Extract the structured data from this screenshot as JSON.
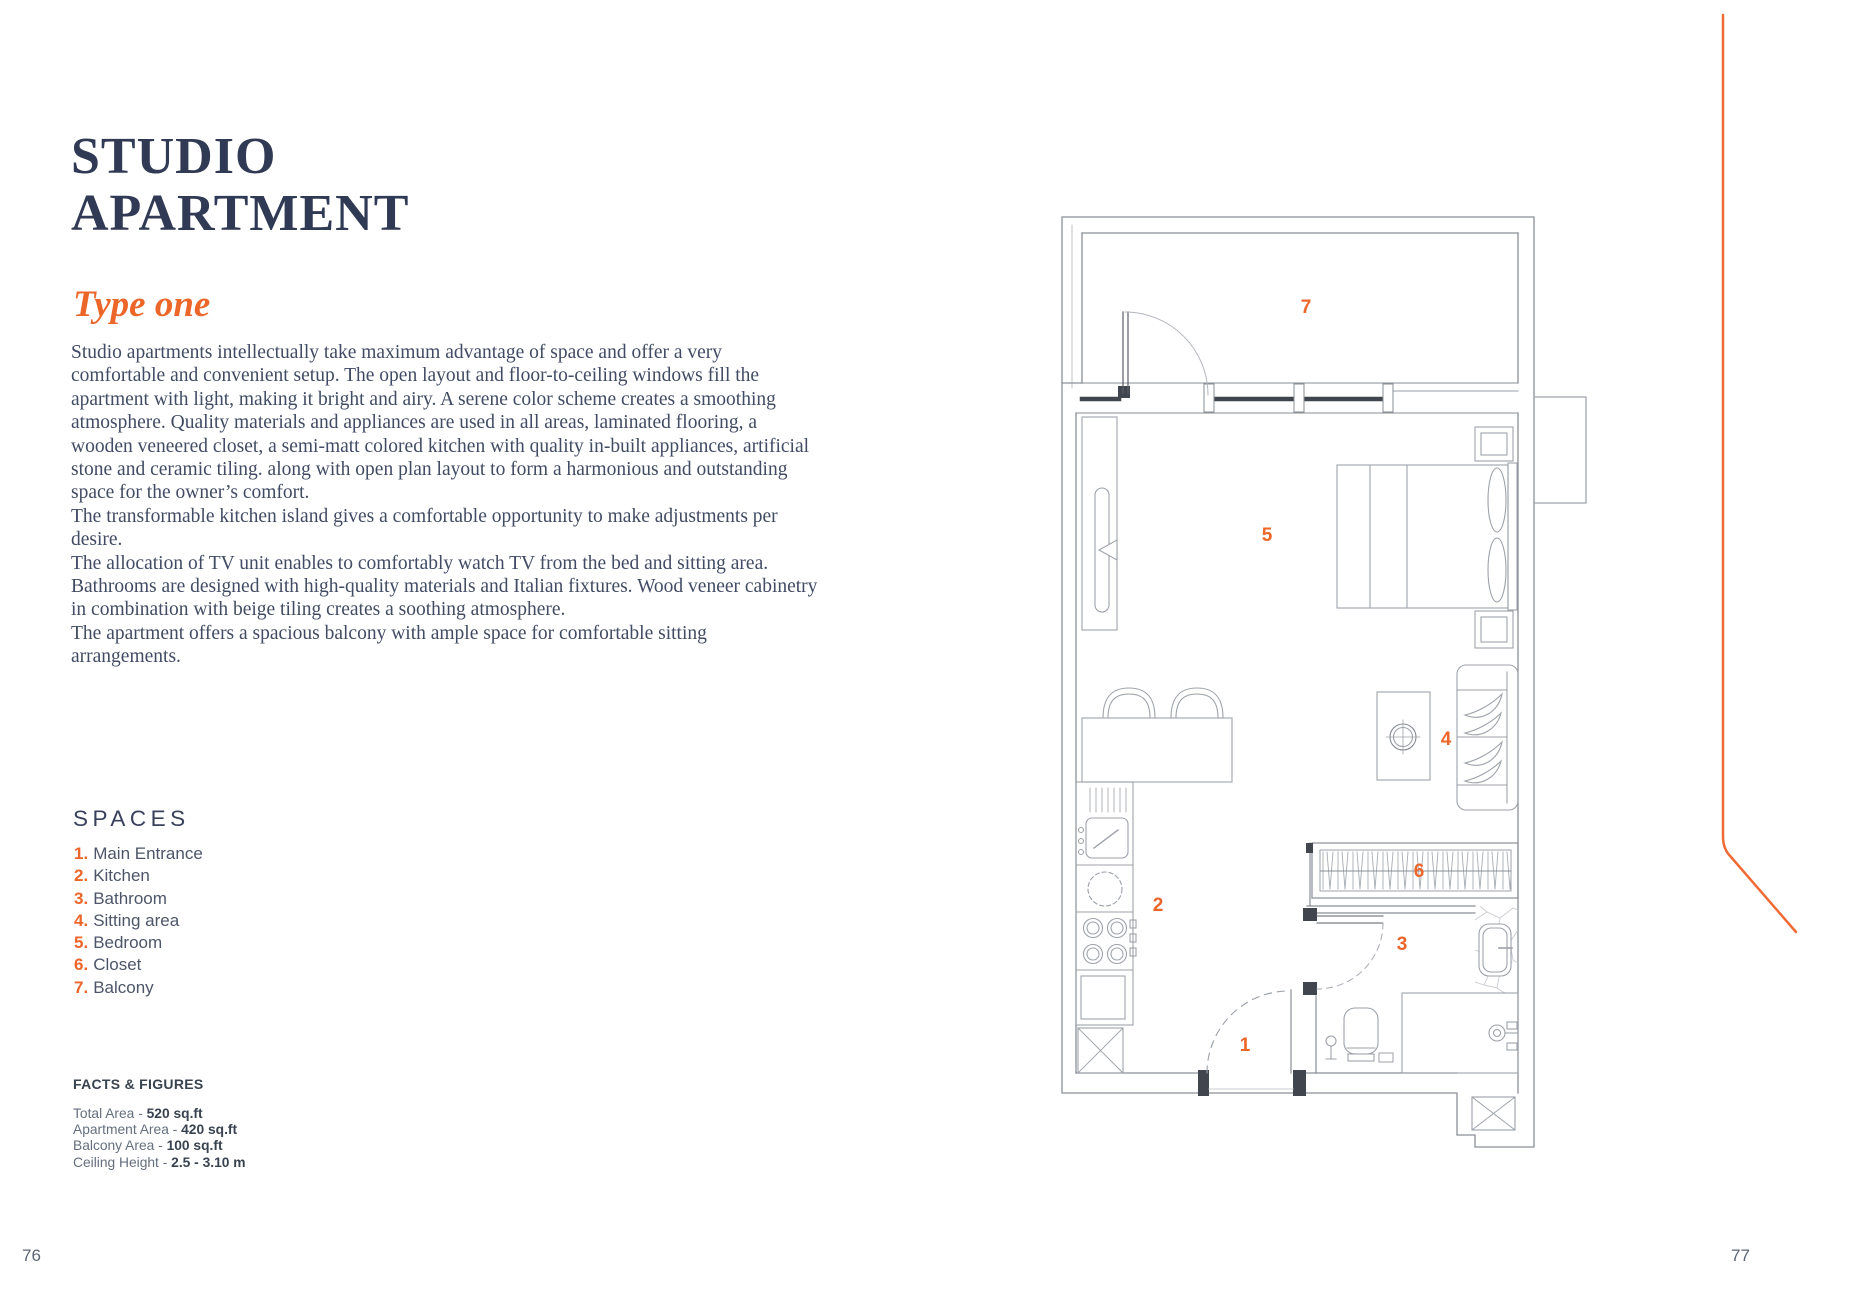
{
  "page": {
    "left_page_number": "76",
    "right_page_number": "77"
  },
  "header": {
    "title_line1": "STUDIO",
    "title_line2": "APARTMENT",
    "subtitle": "Type one"
  },
  "description": {
    "paragraphs": [
      "Studio apartments intellectually take maximum advantage of space and offer a very comfortable and convenient setup. The open layout and floor-to-ceiling windows fill the apartment with light, making it bright and airy. A serene color scheme creates a smoothing atmosphere. Quality materials and appliances are used in all areas, laminated flooring, a wooden veneered closet, a semi-matt colored kitchen with quality in-built appliances, artificial stone and ceramic tiling. along with open plan layout to form a harmonious and outstanding space for the owner’s comfort.",
      "The transformable kitchen island gives a comfortable opportunity to make adjustments per desire.",
      "The allocation of TV unit enables to comfortably watch TV from the bed and sitting area.",
      "Bathrooms are designed with high-quality materials and Italian fixtures. Wood veneer cabinetry in combination with beige tiling creates a soothing atmosphere.",
      "The apartment offers a spacious balcony with ample space for comfortable sitting arrangements."
    ]
  },
  "spaces": {
    "heading": "SPACES",
    "items": [
      {
        "number": "1.",
        "label": "Main Entrance"
      },
      {
        "number": "2.",
        "label": "Kitchen"
      },
      {
        "number": "3.",
        "label": "Bathroom"
      },
      {
        "number": "4.",
        "label": "Sitting area"
      },
      {
        "number": "5.",
        "label": "Bedroom"
      },
      {
        "number": "6.",
        "label": "Closet"
      },
      {
        "number": "7.",
        "label": "Balcony"
      }
    ]
  },
  "facts": {
    "heading": "FACTS & FIGURES",
    "items": [
      {
        "label": "Total Area - ",
        "value": "520 sq.ft"
      },
      {
        "label": "Apartment Area - ",
        "value": "420 sq.ft"
      },
      {
        "label": "Balcony Area - ",
        "value": "100 sq.ft"
      },
      {
        "label": "Ceiling Height - ",
        "value": "2.5 - 3.10 m"
      }
    ]
  },
  "floor_plan": {
    "labels": [
      {
        "number": "1",
        "name": "Main Entrance"
      },
      {
        "number": "2",
        "name": "Kitchen"
      },
      {
        "number": "3",
        "name": "Bathroom"
      },
      {
        "number": "4",
        "name": "Sitting area"
      },
      {
        "number": "5",
        "name": "Bedroom"
      },
      {
        "number": "6",
        "name": "Closet"
      },
      {
        "number": "7",
        "name": "Balcony"
      }
    ]
  },
  "colors": {
    "accent_orange": "#ec6529",
    "title_navy": "#303a54",
    "body_text": "#414b63",
    "plan_line_gray": "#979ca4",
    "plan_dark": "#41464e"
  }
}
